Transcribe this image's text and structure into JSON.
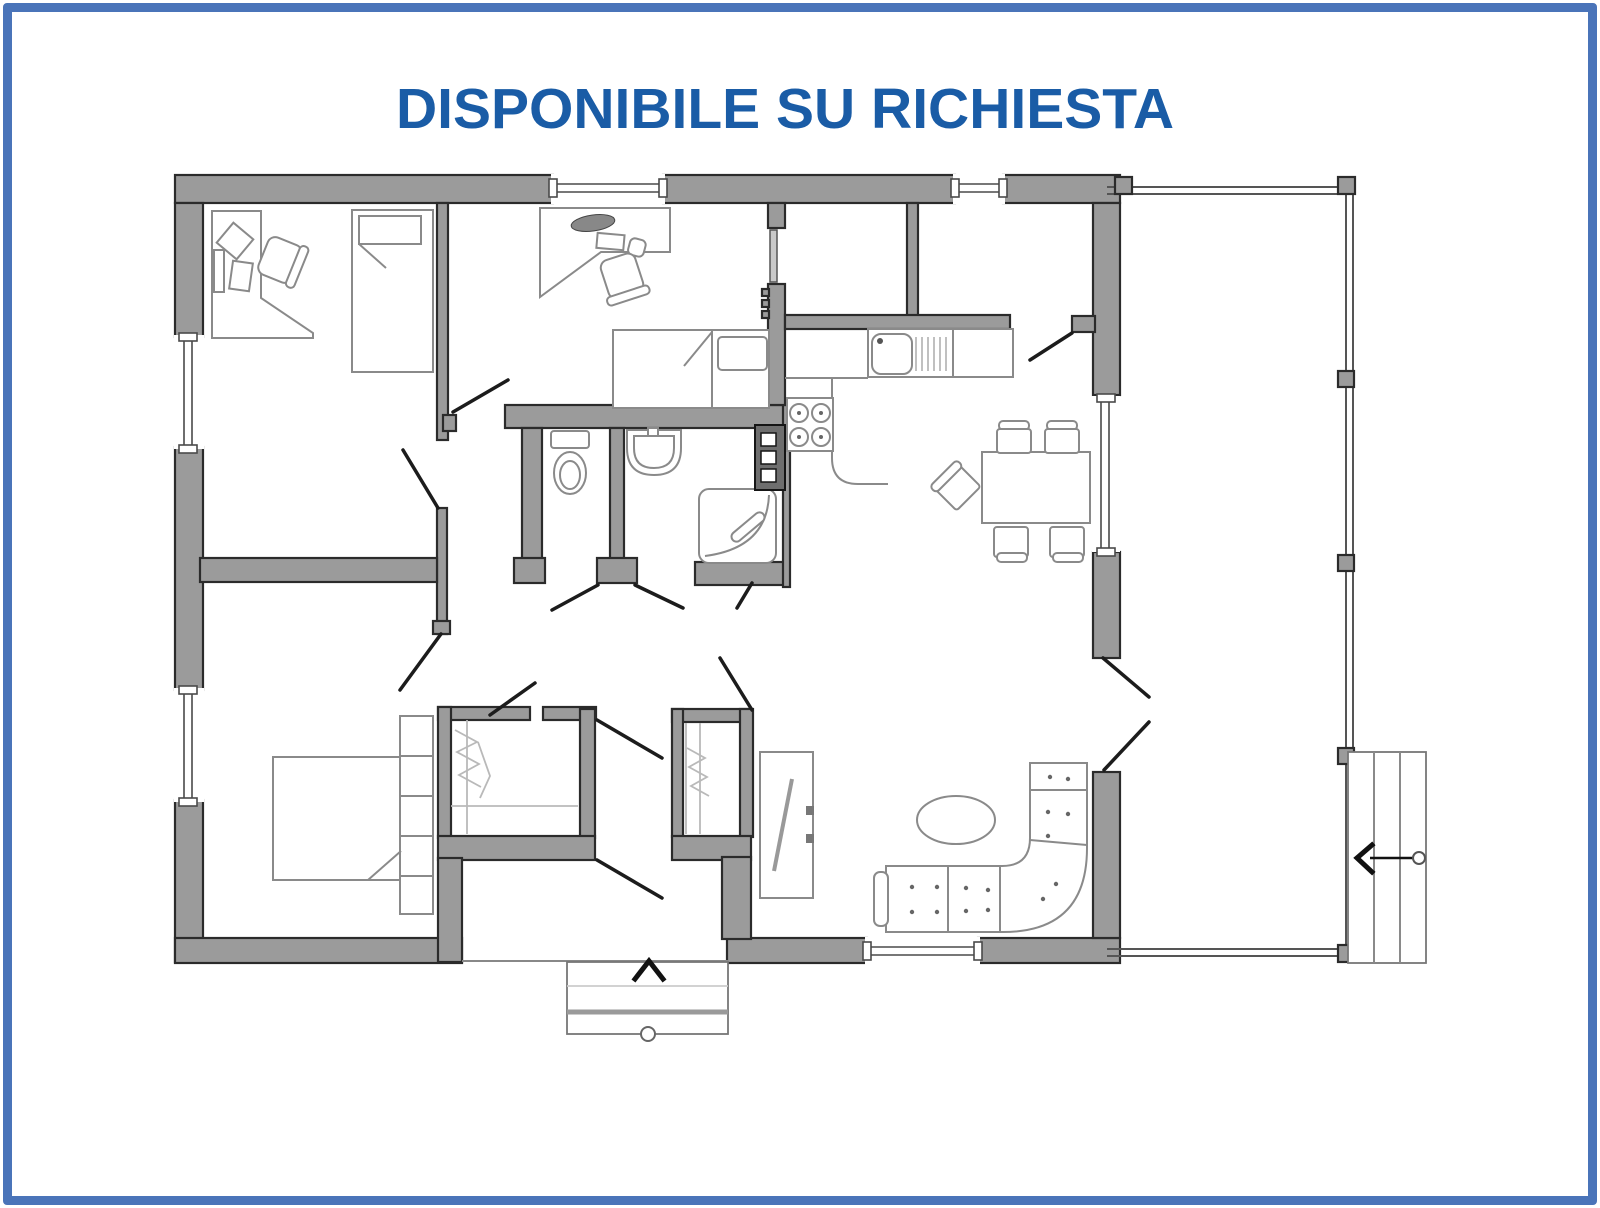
{
  "page": {
    "background": "#ffffff",
    "border_color": "#4a74b9"
  },
  "header": {
    "title": "DISPONIBILE SU RICHIESTA",
    "title_color": "#1a5ca6"
  },
  "colors": {
    "border-blue": "#4a74b9",
    "title-blue": "#1a5ca6",
    "wall-fill": "#9b9b9b",
    "wall-line": "#2b2b2b",
    "furn-line": "#8a8a8a",
    "door-line": "#1c1c1c",
    "porch-line": "#555555"
  },
  "floorplan": {
    "type": "residential-floor-plan",
    "rooms": [
      {
        "name": "bedroom-top-left",
        "furniture": [
          "corner-desk",
          "office-chair",
          "single-bed"
        ]
      },
      {
        "name": "bedroom-top-middle",
        "furniture": [
          "desk",
          "office-chair",
          "monitor",
          "keyboard",
          "mouse",
          "single-bed"
        ]
      },
      {
        "name": "wc",
        "furniture": [
          "toilet"
        ]
      },
      {
        "name": "bathroom",
        "furniture": [
          "washbasin",
          "shower"
        ]
      },
      {
        "name": "kitchen",
        "furniture": [
          "sink",
          "drainboard",
          "counter",
          "stove-4-burners",
          "appliance-column"
        ]
      },
      {
        "name": "pantry",
        "furniture": []
      },
      {
        "name": "dining-area",
        "furniture": [
          "dining-table",
          "chair",
          "chair",
          "chair",
          "chair",
          "chair"
        ]
      },
      {
        "name": "living-room",
        "furniture": [
          "corner-sofa",
          "coffee-table",
          "tv-cabinet"
        ]
      },
      {
        "name": "master-bedroom",
        "furniture": [
          "double-bed",
          "headboard-cabinets"
        ]
      },
      {
        "name": "wardrobe-left",
        "furniture": [
          "hanging-rail"
        ]
      },
      {
        "name": "wardrobe-right",
        "furniture": [
          "hanging-rail"
        ]
      },
      {
        "name": "entry-hall",
        "furniture": []
      }
    ],
    "windows_count": 6,
    "doors_count": 13,
    "stairs": [
      {
        "location": "bottom-entry",
        "direction": "up"
      },
      {
        "location": "right-porch",
        "direction": "left"
      }
    ],
    "porch": {
      "location": "right",
      "posts": 6
    }
  }
}
